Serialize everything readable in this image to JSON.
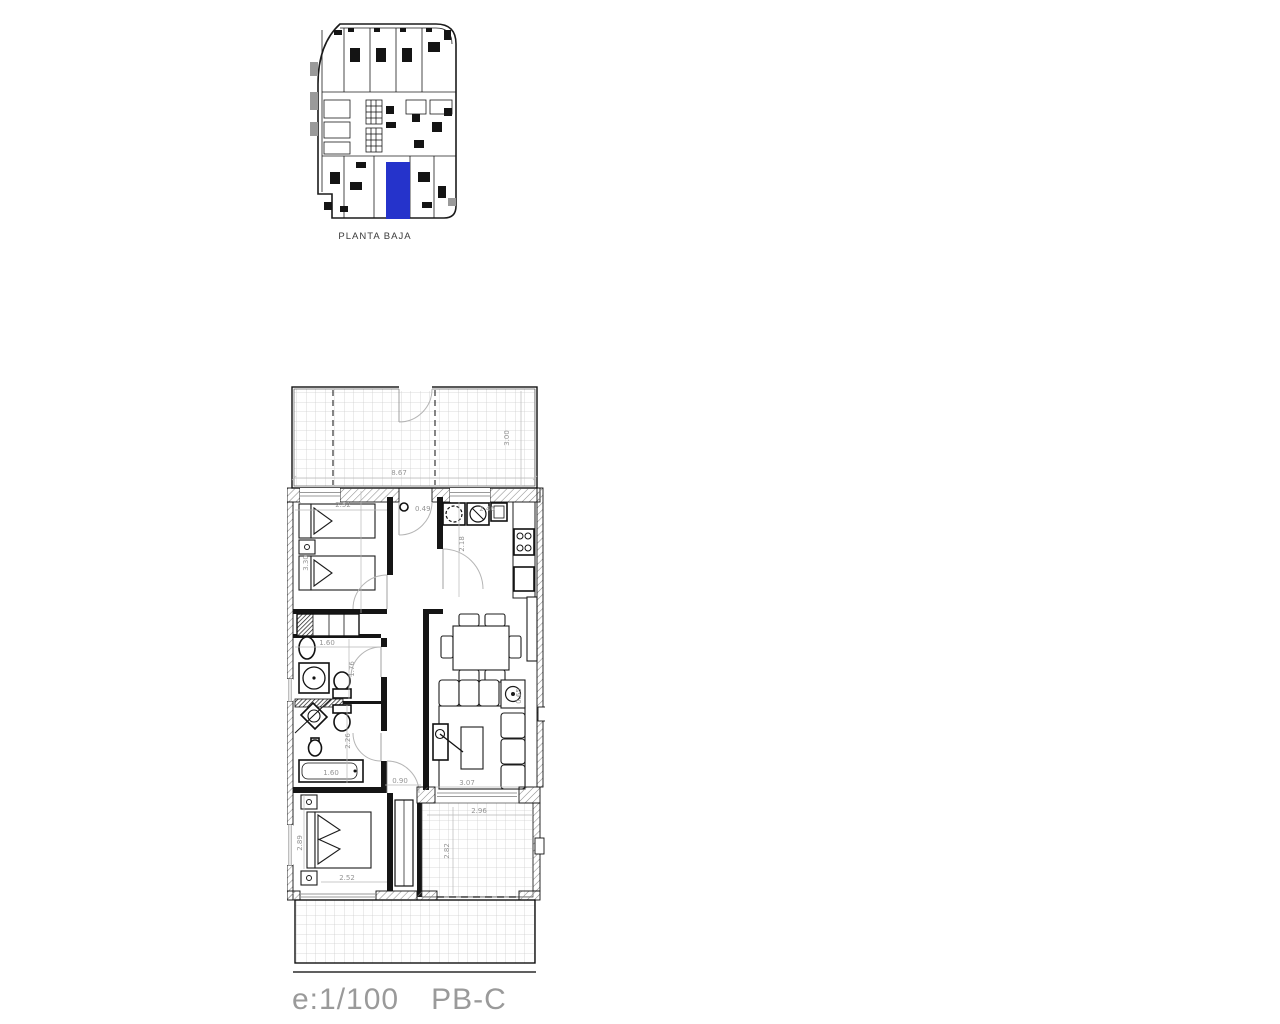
{
  "overview": {
    "title": "PLANTA BAJA",
    "highlight_color": "#2533cb"
  },
  "footer": {
    "scale": "e:1/100",
    "plan_code": "PB-C"
  },
  "plan": {
    "dims": {
      "terrace_top_width": "8.67",
      "terrace_top_depth": "3.00",
      "bedroom2_width": "2.52",
      "bedroom2_depth": "3.30",
      "entrance_door": "0.49",
      "kitchen_width": "2.46",
      "kitchen_depth": "2.18",
      "bath1_width": "1.60",
      "bath1_depth": "1.76",
      "bath2_depth": "2.26",
      "bathtub_length": "1.60",
      "hall_width": "0.90",
      "living_width": "3.07",
      "side_table": "0.65",
      "bedroom1_width": "2.52",
      "bedroom1_depth": "2.89",
      "terrace2_width": "2.96",
      "terrace2_depth": "2.82"
    }
  }
}
